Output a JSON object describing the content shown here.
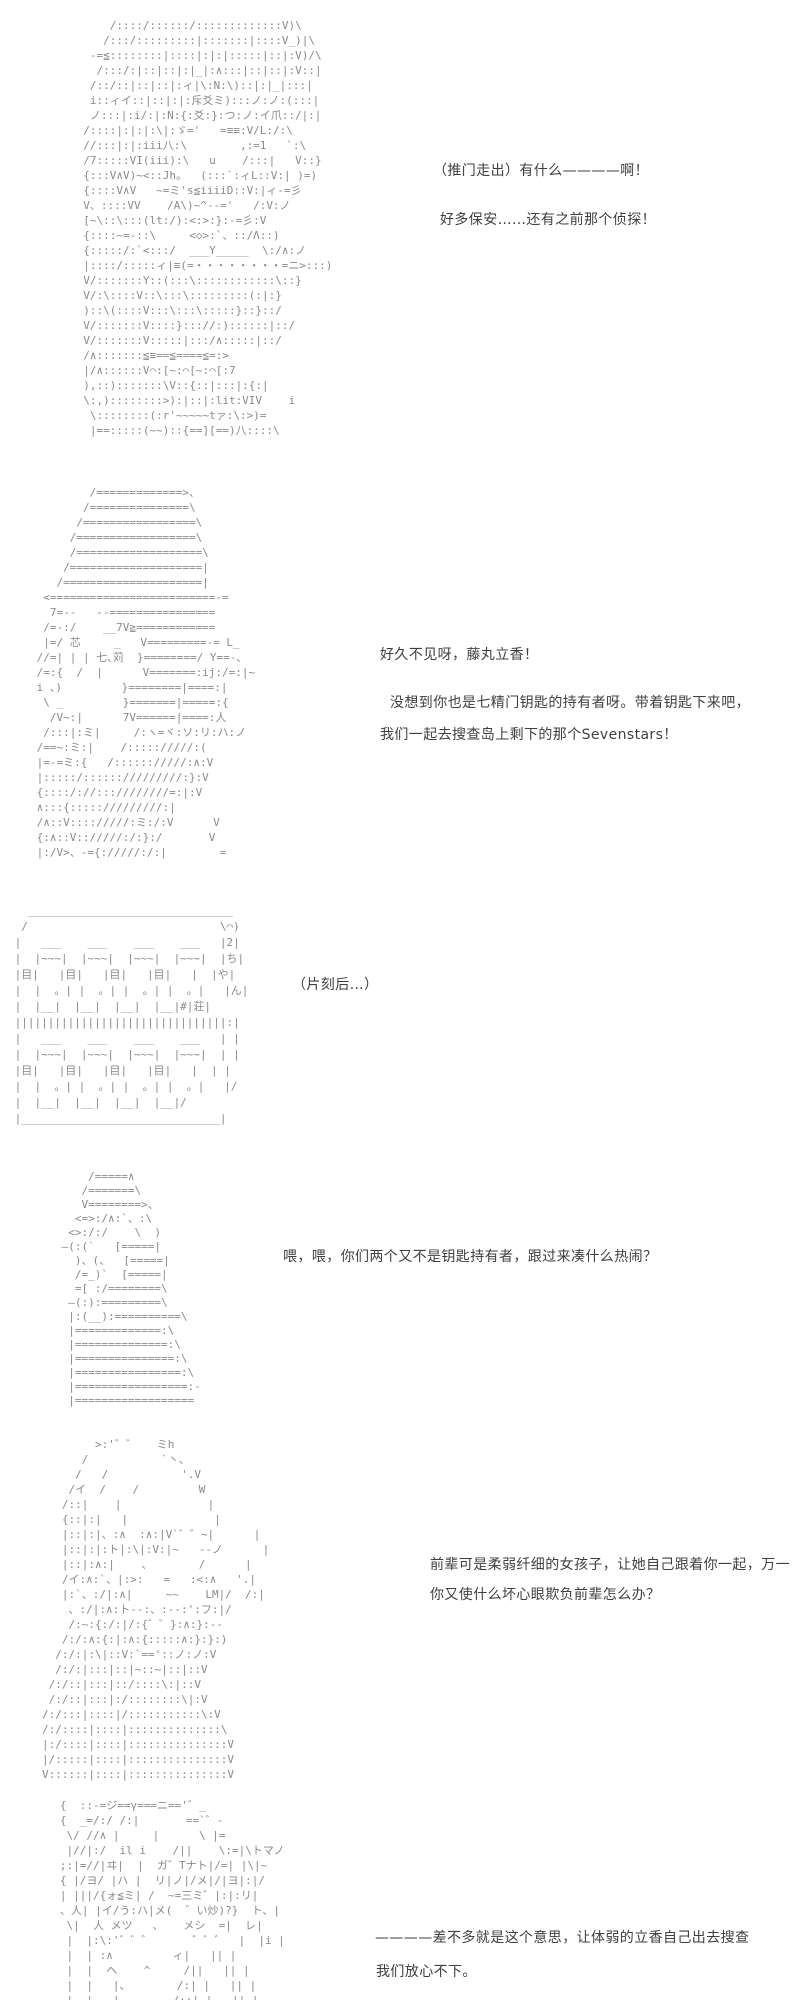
{
  "page": {
    "background": "#ffffff",
    "aa_color": "#8a8a8a",
    "text_color": "#3f3f3f"
  },
  "sections": [
    {
      "name": "scene-1-surprised-girl",
      "aa": "      /::::/::::::/:::::::::::::V)\\\n     /:::/:::::::::|:::::::|::::V_)|\\\n   -=≦::::::::|::::|:|:|:::::|::|:V)/\\\n    /:::/:|::|::|:|_|:∧:::|::|::|:V::|\n   /::/::|::|::|:ィ|\\:N:\\)::|:|_|:::|\n   i::ィイ::|::|:|:斥爻ミ):::ノ:ノ:(:::|\n   ノ:::|:i/:|:N:{:爻:}:つ:ノ:イ爪::/|:|\n  /::::|:|:|:\\|:ゞ='   =≡≡:V/L:/:\\\n  //:::|:|:iii八:\\        ,:=1   `:\\\n  /7:::::VI(iii):\\   u    /:::|   V::}\n  {:::V∧V)~<::Jh。  (:::`:ィL::V:| )=)\n  {::::V∧V   ~=ミ's≦iiiiD::V:|ィ-=彡\n  V、::::VV    /A\\)~^--='   /:V:ノ\n  [~\\::\\:::(lt:/):<:>:}:-=彡:V\n  {::::~=-::\\     <◇>:`、::/Λ::)\n  {:::::/:`<:::/  ___Y_____  \\:/∧:ノ\n  |::::/:::::ィ|≡(=・・・・・・・・=ニ>:::)\n  V/:::::::Y::(:::\\::::::::::::\\::}\n  V/:\\::::V::\\:::\\:::::::::(:|:}\n  )::\\(::::V:::\\:::\\:::::}::}::/\n  V/:::::::V::::}::://:)::::::|::/\n  V/:::::::V:::::|:::/∧:::::|::/\n  /∧:::::::≦≡==≦====≦=:>\n  |/∧::::::V⌒:[~:⌒[~:⌒[:7\n  ),::):::::::\\V::{::|:::|:{:|\n  \\:,)::::::::>):|::|:lit:VIV    i\n   \\::::::::(:r'~~~~~tァ:\\:>)=\n   |==:::::(~~)::{==][==)八::::\\",
      "dialogue": [
        {
          "text": "（推门走出）有什么————啊！"
        },
        {
          "text": "好多保安……还有之前那个侦探！"
        }
      ]
    },
    {
      "name": "scene-2-detective-with-hat",
      "aa": "         /=============>、\n        /===============\\\n       /=================\\\n      /==================\\\n      /===================\\\n     /====================|\n    /=====================|\n  <=========================-=\n   7=--   --================\n  /=-:/    __7V≧============\n  |=/ 芯     _   V=========-= L_\n //=| | | 七､苅  }========/ Y==-、\n /=:{  /  |      V=======:ij:/=:|~\n i 、)         }========|====:|\n  \\ _         }=======|=====:{\n   /V~:|      7V======|====:人\n  /:::|:ミ|     /:ヽ=ヾ:ソ:リ:ハ:ノ\n /==~:ミ:|    /::::://///:(\n |=-=ミ:{   /:::::://///:∧:V\n |:::::/:::::://///////:}:V\n {::::/://:::////////=:|:V\n ∧:::{::::://///////:|\n /∧::V:::://///:ミ:/:V      V\n {:∧::V:://///:/:}:/       V\n |:/V>、-={://///:/:|        =",
      "dialogue": [
        {
          "text": "好久不见呀，藤丸立香！"
        },
        {
          "text": "没想到你也是七精门钥匙的持有者呀。带着钥匙下来吧，"
        },
        {
          "text": "我们一起去搜查岛上剩下的那个Sevenstars！"
        }
      ]
    },
    {
      "name": "scene-3-apartment-building",
      "sign": "2ちゃん荘",
      "aa": "   _______________________________\n  /                             \\⌒)\n |   ___    ___    ___    ___   |2|\n |  |~~~|  |~~~|  |~~~|  |~~~|  |ち|\n |目|   |目|   |目|   |目|   |  |や|\n |  |  。| |  。| |  。| |  。|   |ん|\n |  |__|  |__|  |__|  |__|#|荘|\n ||||||||||||||||||||||||||||||||:|\n |   ___    ___    ___    ___   | |\n |  |~~~|  |~~~|  |~~~|  |~~~|  | |\n |目|   |目|   |目|   |目|   |  | |\n |  |  。| |  。| |  。| |  。|   |/\n |  |__|  |__|  |__|  |__|/\n |______________________________|",
      "dialogue": [
        {
          "text": "（片刻后…）"
        }
      ]
    },
    {
      "name": "scene-4-small-caped-figure",
      "aa": "     /=====∧\n    /=======\\\n    V========>、\n   <=>:/∧:`、:\\\n  <>:/:/    \\  )\n ―(:(`   [=====|\n   )、(、  [=====|\n   /=_)`  [=====|\n   =[ :/========\\\n  ―(:):=========\\\n  |:(__):==========\\\n  |=============:\\\n  |==============:\\\n  |===============:\\\n  |================:\\\n  |=================:-\n  |==================",
      "dialogue": [
        {
          "text": "喂，喂，你们两个又不是钥匙持有者，跟过来凑什么热闹？"
        }
      ]
    },
    {
      "name": "scene-5-longhaired-girl",
      "aa": "        >:'゛゛   ミh\n      /           `丶、\n     /   /           '.V\n    /イ  /    /         W\n   /::|    |             |\n   {::|:|   |             |\n   |::|:|、:∧  :∧:|V`゛゛~|      |\n   |::|:|:ト|:\\|:V:|~   --ノ      |\n   |::|:∧:|    、       /      |\n   /イ:∧:`、|:>:   =   :<:∧   '.|\n   |:`、:/|:∧|     ~~    LM|/  /:|\n    、:/|:∧:ト--:、:--:':フ:|/\n    /:~:{:/:|/:{゛゛}:∧:}:--\n   /:/:∧:{:|:∧:{:::::∧:}:}:)\n  /:/:|:\\|::V:`=='::ノ:ノ:V\n  /:/:|:::|::|~::~|::|::V\n /:/::|:::|::/::::\\:|::V\n /:/::|:::|:/::::::::\\|:V\n/:/:::|::::|/:::::::::::\\:V\n/:/::::|::::|::::::::::::::\\\n|:/::::|::::|:::::::::::::::V\n|/:::::|::::|:::::::::::::::V\nV::::::|::::|:::::::::::::::V",
      "dialogue": [
        {
          "text": "前辈可是柔弱纤细的女孩子，让她自己跟着你一起，万一"
        },
        {
          "text": "你又使什么坏心眼欺负前辈怎么办？"
        }
      ]
    },
    {
      "name": "scene-6-figure-bottom",
      "aa": "   {  ::-=ジ==γ===ニ=='゛_\n   {  _=/:/ /:|       ==`゛-\n    \\/ //∧ |     |      \\ |=\n    |//|:/  il i    /||    \\:=|\\トマノ\n   ;:|=//|ヰ|  |  ガ゛Tナト|/=| |\\|~\n   { |/ヨ/ |ハ |  リ|ノ|/メ|/|ヨ|:|/\n   | |||/{ォ≦ミ| /  ~=三ミ゛|:|:リ|\n   、人| |イ/う:ハ|メ(  ゛い炒)?}  ト、|\n    \\|  人 メツ   、   メシ  =|  レ|\n    |  |:\\:'゛゛゛      ゛゛゛  |  |i |\n    |  | :∧         ィ|   || |\n    |  |  ヘ    ^     /||   || |\n    |  |   |、       /:| |   || |\n    |  |   |        /::| |   || |",
      "dialogue": [
        {
          "text": "————差不多就是这个意思，让体弱的立香自己出去搜查"
        },
        {
          "text": "我们放心不下。"
        }
      ]
    }
  ]
}
